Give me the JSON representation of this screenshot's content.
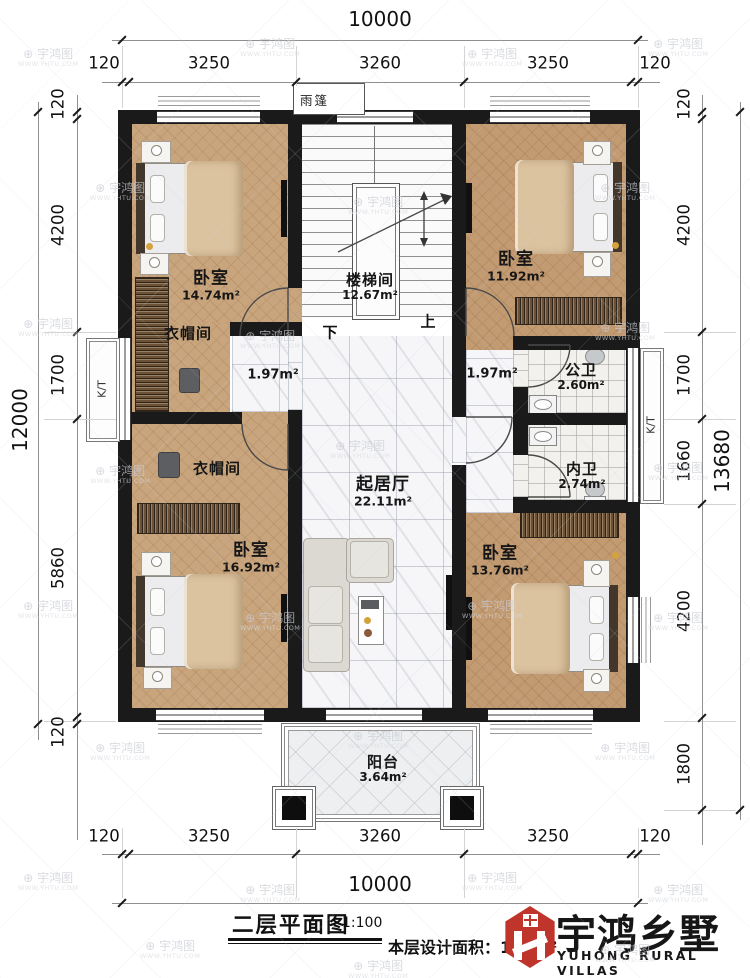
{
  "plan": {
    "canopy": "雨篷",
    "stairs": {
      "down": "下",
      "up": "上"
    },
    "ac_unit": "K/T",
    "rooms": [
      {
        "name": "卧室",
        "area": "14.74m²"
      },
      {
        "name": "楼梯间",
        "area": "12.67m²"
      },
      {
        "name": "卧室",
        "area": "11.92m²"
      },
      {
        "name": "衣帽间",
        "area": ""
      },
      {
        "name": "",
        "area": "1.97m²"
      },
      {
        "name": "",
        "area": "1.97m²"
      },
      {
        "name": "公卫",
        "area": "2.60m²"
      },
      {
        "name": "内卫",
        "area": "2.74m²"
      },
      {
        "name": "衣帽间",
        "area": ""
      },
      {
        "name": "起居厅",
        "area": "22.11m²"
      },
      {
        "name": "卧室",
        "area": "16.92m²"
      },
      {
        "name": "卧室",
        "area": "13.76m²"
      },
      {
        "name": "阳台",
        "area": "3.64m²"
      }
    ]
  },
  "dimensions": {
    "top": {
      "segments": [
        "120",
        "3250",
        "3260",
        "3250",
        "120"
      ],
      "total": "10000"
    },
    "bottom": {
      "segments": [
        "120",
        "3250",
        "3260",
        "3250",
        "120"
      ],
      "total": "10000"
    },
    "left": {
      "segments": [
        "120",
        "4200",
        "1700",
        "5860",
        "120"
      ],
      "total": "12000"
    },
    "right": {
      "segments": [
        "120",
        "4200",
        "1700",
        "1660",
        "4200",
        "1800"
      ],
      "total": "13680"
    }
  },
  "title_block": {
    "title": "二层平面图",
    "scale": "1:100",
    "area_note": "本层设计面积：130m²"
  },
  "brand": {
    "name": "宇鸿乡墅",
    "tagline": "YUHONG RURAL VILLAS",
    "logo_color": "#c0352b"
  },
  "watermark": {
    "text": "宇鸿图",
    "url": "WWW.YHTU.COM"
  },
  "colors": {
    "wall": "#1a1a1a",
    "wood": "#c9a57e",
    "marble": "#f6f6f8",
    "accent_red": "#c0352b"
  }
}
